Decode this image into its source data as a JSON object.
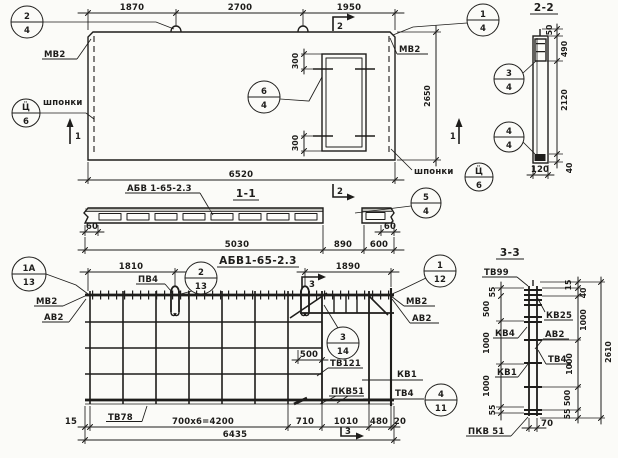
{
  "plan": {
    "label_series": "АБВ 1-65-2.3",
    "dim_1870": "1870",
    "dim_2700": "2700",
    "dim_1950": "1950",
    "dim_6520": "6520",
    "dim_2650": "2650",
    "dim_300_top": "300",
    "dim_300_bot": "300",
    "mv2_left": "МВ2",
    "mv2_right": "МВ2",
    "shponki_left": "шпонки",
    "shponki_right": "шпонки",
    "callout_24": {
      "n": "2",
      "d": "4"
    },
    "callout_14": {
      "n": "1",
      "d": "4"
    },
    "callout_64": {
      "n": "6",
      "d": "4"
    },
    "callout_key_left": {
      "n": "Ц̈",
      "d": "6"
    },
    "callout_key_right": {
      "n": "Ц̈",
      "d": "6"
    },
    "mark_1_left": "1",
    "mark_1_right": "1",
    "mark_2_top": "2",
    "mark_2_bot": "2"
  },
  "sec22": {
    "title": "2-2",
    "dim_50": "50",
    "dim_490": "490",
    "dim_2120": "2120",
    "dim_40": "40",
    "dim_120": "120",
    "callout_34": {
      "n": "3",
      "d": "4"
    },
    "callout_44": {
      "n": "4",
      "d": "4"
    }
  },
  "sec11": {
    "title": "1-1",
    "label_series": "АБВ 1-65-2.3",
    "dim_60_l": "60",
    "dim_60_r": "60",
    "dim_5030": "5030",
    "dim_890": "890",
    "dim_600": "600",
    "callout_54": {
      "n": "5",
      "d": "4"
    }
  },
  "mesh": {
    "title": "АБВ1-65-2.3",
    "dim_1810": "1810",
    "dim_1890": "1890",
    "dim_500": "500",
    "dim_15": "15",
    "dim_4200": "700x6=4200",
    "dim_710": "710",
    "dim_1010": "1010",
    "dim_480": "480",
    "dim_20": "20",
    "dim_6435": "6435",
    "pv4": "ПВ4",
    "tv78": "ТВ78",
    "tv121": "ТВ121",
    "kv1": "КВ1",
    "pkv51": "ПКВ51",
    "tv4": "ТВ4",
    "mv2_left": "МВ2",
    "av2_left": "АВ2",
    "mv2_right": "МВ2",
    "av2_right": "АВ2",
    "callout_1a13": {
      "n": "1А",
      "d": "13"
    },
    "callout_213": {
      "n": "2",
      "d": "13"
    },
    "callout_112": {
      "n": "1",
      "d": "12"
    },
    "callout_314": {
      "n": "3",
      "d": "14"
    },
    "callout_411": {
      "n": "4",
      "d": "11"
    },
    "mark_3_top": "3",
    "mark_3_bot": "3"
  },
  "sec33": {
    "title": "3-3",
    "tv99": "ТВ99",
    "kv4": "КВ4",
    "kv1": "КВ1",
    "pkv51": "ПКВ 51",
    "kv25": "КВ25",
    "av2": "АВ2",
    "tv4": "ТВ4",
    "left_55_t": "55",
    "left_500": "500",
    "left_1000_a": "1000",
    "left_1000_b": "1000",
    "left_55_b": "55",
    "right_15": "15",
    "right_40": "40",
    "right_1000_a": "1000",
    "right_1000_b": "1000",
    "right_500": "500",
    "right_55": "55",
    "total_2610": "2610",
    "dim_70": "70"
  }
}
